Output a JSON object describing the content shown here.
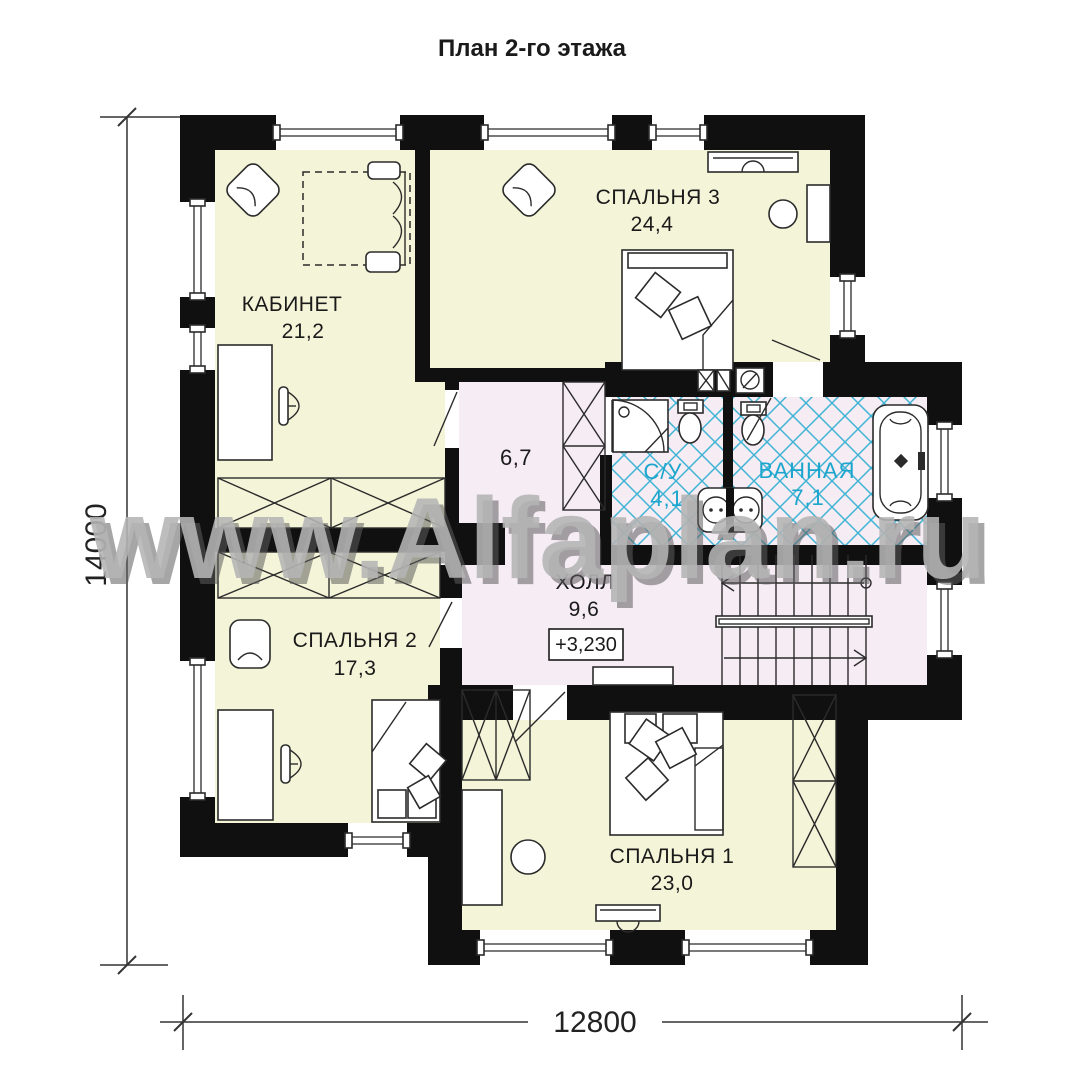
{
  "page": {
    "title": "План 2-го этажа",
    "watermark": "www.Alfaplan.ru"
  },
  "rooms": [
    {
      "key": "kabinet",
      "name": "КАБИНЕТ",
      "area": "21,2"
    },
    {
      "key": "bedroom3",
      "name": "СПАЛЬНЯ 3",
      "area": "24,4"
    },
    {
      "key": "wc",
      "name": "С/У",
      "area": "4,1"
    },
    {
      "key": "bathroom",
      "name": "ВАННАЯ",
      "area": "7,1"
    },
    {
      "key": "corridor",
      "name": "",
      "area": "6,7"
    },
    {
      "key": "hall",
      "name": "ХОЛЛ",
      "area": "9,6"
    },
    {
      "key": "bedroom2",
      "name": "СПАЛЬНЯ 2",
      "area": "17,3"
    },
    {
      "key": "bedroom1",
      "name": "СПАЛЬНЯ 1",
      "area": "23,0"
    }
  ],
  "annotations": {
    "elevation": "+3,230"
  },
  "dimensions": {
    "height": "14000",
    "width": "12800"
  },
  "colors": {
    "dry_floor": "#f4f5d8",
    "wet_floor": "#f6ecf4",
    "tile_line": "#3eb3d3",
    "wet_label": "#1ca6cd",
    "wall": "#101010",
    "watermark": "#b5b5b5"
  }
}
